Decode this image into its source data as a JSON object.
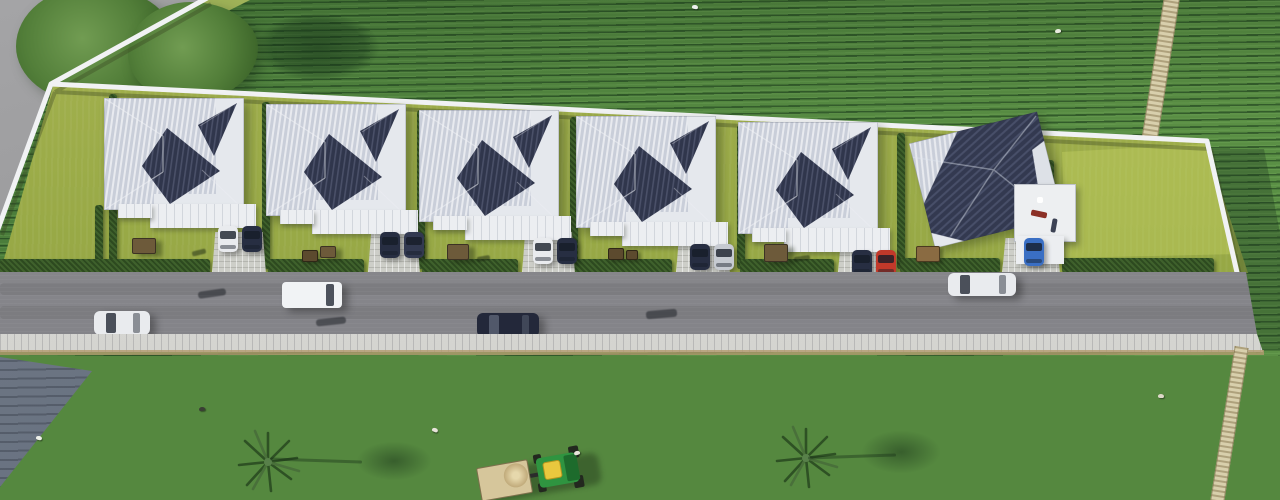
{
  "scene": {
    "title": "Aerial 3D render of a six-villa residential development surrounded by crop fields",
    "view": "top-down aerial render, no on-screen text",
    "environment": {
      "north_field": {
        "type": "row-crop field",
        "base_color": "#55883f",
        "row_color": "#2e5a31"
      },
      "south_field": {
        "type": "row-crop field",
        "base_color": "#79a168",
        "row_color": "#6c9259"
      },
      "west_street_color": "#9c9c9e",
      "southwest_wedge_color": "#5f6876",
      "dirt_path_color": "#d8cfac",
      "trees_top_left": 2,
      "palm_tree_count": 2,
      "bird_count": 6
    },
    "compound": {
      "perimeter_wall_color": "#f0f1f3",
      "lawn_color": "#98a946",
      "hedge_color": "#3f612c",
      "house_count": 6,
      "empty_lots": 2,
      "houses": [
        {
          "id": 1,
          "style": "hip-roof villa, two-tone navy/silver roof",
          "cars": [
            "#e9ebee",
            "#272e42"
          ]
        },
        {
          "id": 2,
          "style": "hip-roof villa, two-tone navy/silver roof",
          "cars": [
            "#272e42",
            "#323950"
          ]
        },
        {
          "id": 3,
          "style": "hip-roof villa, two-tone navy/silver roof",
          "cars": [
            "#e9ebee",
            "#272e42"
          ]
        },
        {
          "id": 4,
          "style": "hip-roof villa, two-tone navy/silver roof",
          "cars": [
            "#272e42",
            "#c6cad1"
          ]
        },
        {
          "id": 5,
          "style": "hip-roof villa, two-tone navy/silver roof",
          "cars": [
            "#272e42",
            "#c2392a"
          ]
        },
        {
          "id": 6,
          "style": "corner villa with rooftop terrace and carport",
          "cars": [
            "#3a6fc4"
          ]
        }
      ]
    },
    "road": {
      "surface_color": "#89898d",
      "sidewalk_color": "#d9d9d5",
      "vehicles": [
        {
          "type": "hatchback",
          "color": "#e9ebee"
        },
        {
          "type": "van",
          "color": "#f1f3f5"
        },
        {
          "type": "sedan",
          "color": "#23283a"
        },
        {
          "type": "sedan",
          "color": "#e9ebee"
        }
      ],
      "motorbike_shadow_count": 3
    },
    "farm": {
      "tractor": {
        "body_color": "#2f9440",
        "cab_color": "#e9c83e",
        "trailer_color": "#d6c69b"
      }
    }
  }
}
